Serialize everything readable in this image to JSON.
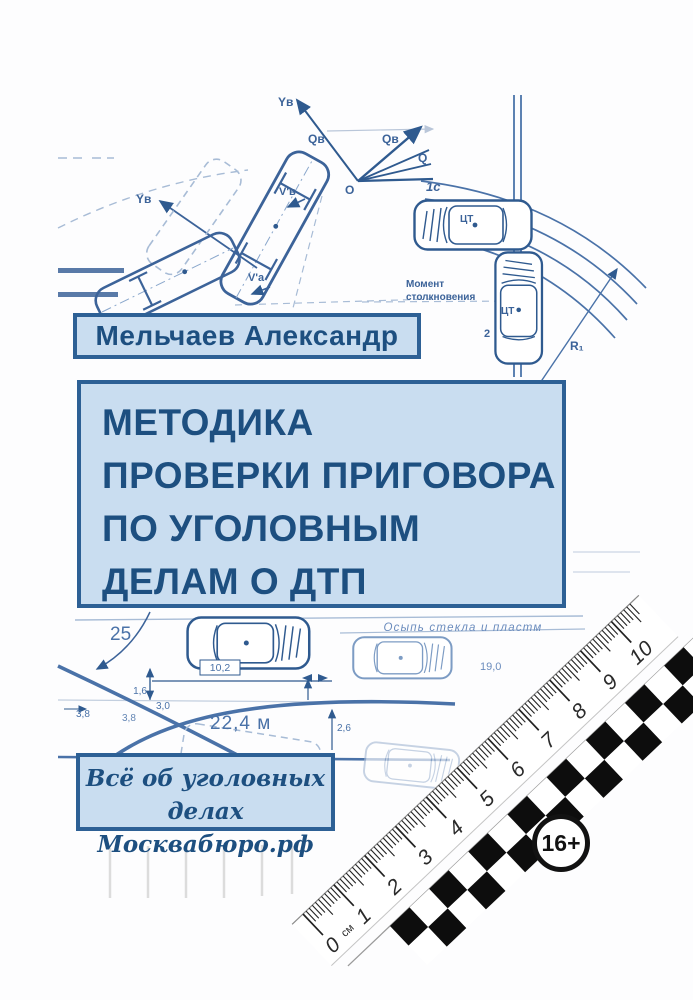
{
  "cover": {
    "author_plate": {
      "text": "Мельчаев Александр"
    },
    "title_plate": {
      "lines": [
        "МЕТОДИКА",
        "ПРОВЕРКИ ПРИГОВОРА",
        "ПО УГОЛОВНЫМ",
        "ДЕЛАМ О ДТП"
      ]
    },
    "footer_plate": {
      "line1": "Всё об уголовных делах",
      "line2": "Москвабюро.рф"
    },
    "age_badge": "16+",
    "colors": {
      "plate_fill": "#c9ddf0",
      "plate_border": "#2d6095",
      "plate_text": "#1d4f80",
      "diagram_line": "#3c6399",
      "diagram_light": "#a8bcd6",
      "scale_black": "#0d0d0d"
    }
  },
  "diagram": {
    "labels": {
      "y_axis_top": "Yв",
      "q_left": "Qв",
      "q_right": "Qв",
      "q": "Q",
      "origin": "O",
      "y_axis_left": "Yв",
      "v_b": "V'в",
      "v_a": "V'а",
      "pos1": "1c",
      "ct": "ЦТ",
      "pos2": "2",
      "radius": "R₁",
      "moment1": "Момент",
      "moment2": "столкновения",
      "debris": "Осыпь стекла и пластм"
    },
    "measurements": {
      "m25": "25",
      "m102": "10,2",
      "m16": "1,6",
      "m38a": "3,8",
      "m38b": "3,8",
      "m30": "3,0",
      "m224": "22,4 м",
      "m26": "2,6",
      "m190": "19,0"
    },
    "ruler": {
      "unit": "см",
      "numbers": [
        "0",
        "1",
        "2",
        "3",
        "4",
        "5",
        "6",
        "7",
        "8",
        "9",
        "10"
      ]
    }
  }
}
